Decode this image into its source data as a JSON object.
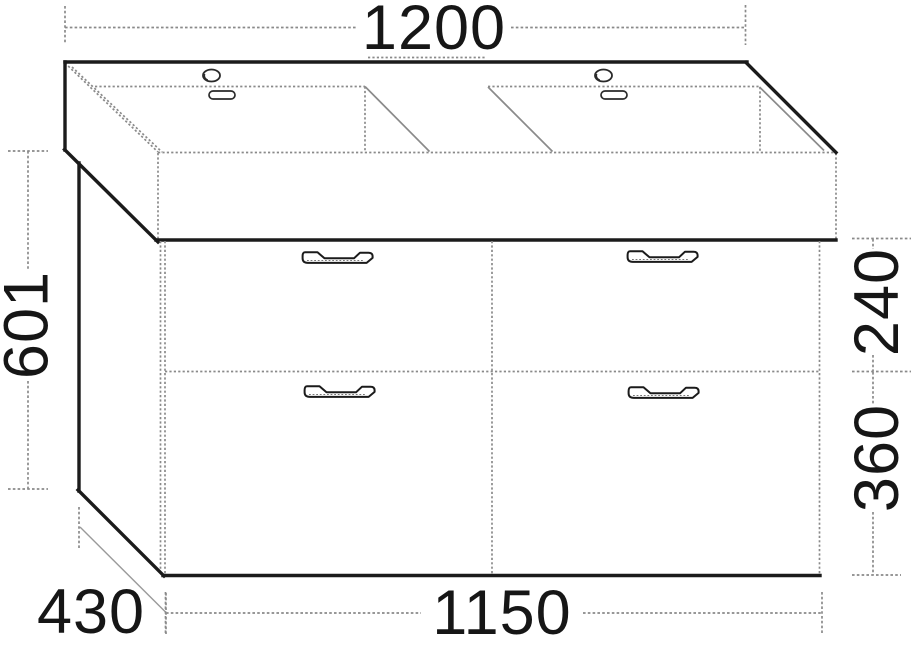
{
  "dimensions": {
    "overall_width_mm": "1200",
    "overall_height_mm": "601",
    "upper_drawer_height_mm": "240",
    "lower_drawer_height_mm": "360",
    "cabinet_width_mm": "1150",
    "cabinet_depth_mm": "430"
  },
  "colors": {
    "background": "#ffffff",
    "outline_dark": "#1b1b1b",
    "hidden_line_gray": "#8a8a8a",
    "dimension_text": "#161616"
  }
}
